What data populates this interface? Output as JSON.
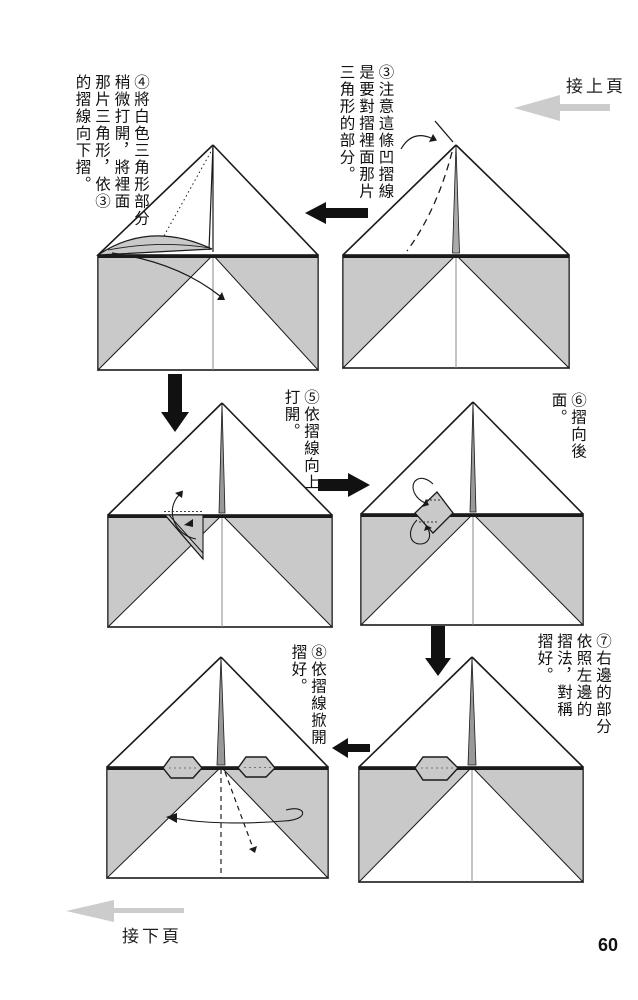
{
  "page": {
    "number": "60"
  },
  "nav": {
    "prev": {
      "label": "接上頁"
    },
    "next": {
      "label": "接下頁"
    }
  },
  "instructions": {
    "step3": "③注意這條凹摺線\n是要對摺裡面那片\n三角形的部分。",
    "step4": "④將白色三角形部分\n稍微打開，將裡面\n那片三角形，依③\n的摺線向下摺。",
    "step5": "⑤依摺線向上\n打開。",
    "step6": "⑥摺向後面。",
    "step7": "⑦右邊的部分\n依照左邊的\n摺法，對稱\n摺好。",
    "step8": "⑧依摺線掀開\n摺好。"
  },
  "colors": {
    "paper_shade": "#c9c9c9",
    "ink": "#1a1a1a",
    "nav_arrow": "#cccccc"
  }
}
